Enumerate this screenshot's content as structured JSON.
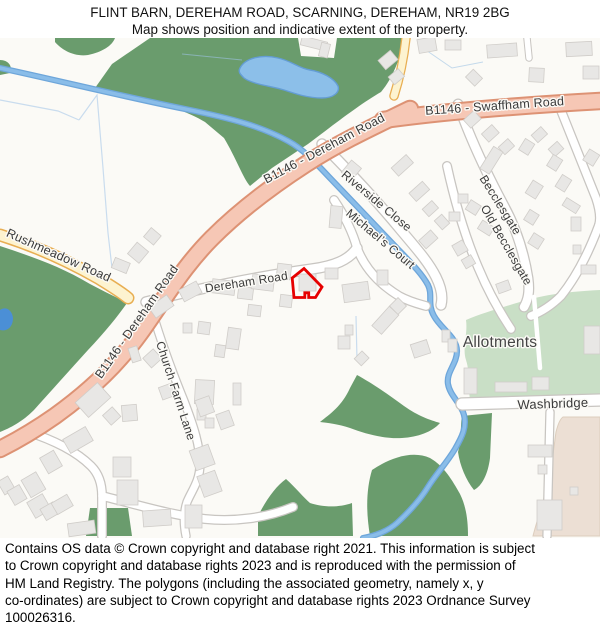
{
  "title": {
    "line1": "FLINT BARN, DEREHAM ROAD, SCARNING, DEREHAM, NR19 2BG",
    "line2": "Map shows position and indicative extent of the property."
  },
  "map": {
    "road_labels": {
      "b1146_swaffham": "B1146 - Swaffham Road",
      "b1146_dereham": "B1146 - Dereham Road",
      "rushmeadow": "Rushmeadow Road",
      "riverside_close": "Riverside Close",
      "michaels_court": "Michael’s Court",
      "becclesgate": "Becclesgate",
      "old_becclesgate": "Old Becclesgate",
      "dereham_road": "Dereham Road",
      "church_farm_lane": "Church Farm Lane",
      "washbridge": "Washbridge"
    },
    "area_labels": {
      "allotments": "Allotments"
    },
    "colors": {
      "background": "#fbfaf6",
      "woodland": "#6a9c6d",
      "allotments_green": "#c9dfc6",
      "stream": "#8abde9",
      "pond": "#8cbfe9",
      "b_road_fill": "#f6c7b5",
      "b_road_casing": "#dd9274",
      "minor_road_fill": "#fdf3d0",
      "minor_road_casing": "#e8ae52",
      "white_road_casing": "#c8c5c1",
      "building_fill": "#e8e7e5",
      "urban_beige": "#ecdfd4",
      "property_outline_red": "#e60000"
    }
  },
  "footer": {
    "lines": [
      "Contains OS data © Crown copyright and database right 2021. This information is subject",
      "to Crown copyright and database rights 2023 and is reproduced with the permission of",
      "HM Land Registry. The polygons (including the associated geometry, namely x, y",
      "co-ordinates) are subject to Crown copyright and database rights 2023 Ordnance Survey",
      "100026316."
    ]
  }
}
